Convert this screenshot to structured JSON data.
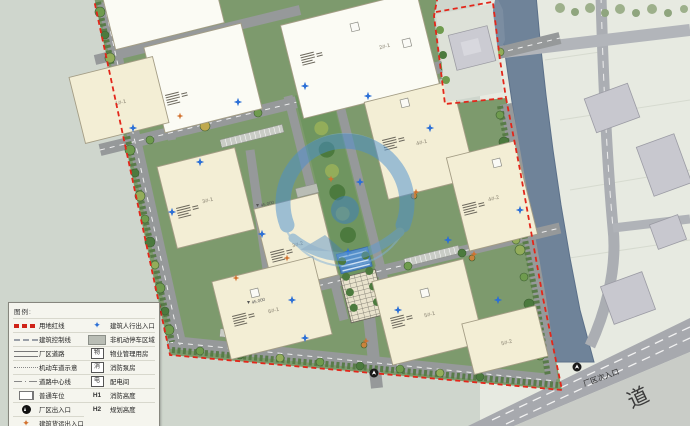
{
  "map": {
    "secondary_entrance_label": "厂区次入口",
    "road_label": "道",
    "elevations": [
      "45.000",
      "45.000"
    ]
  },
  "buildings": [
    {
      "label": "2#-1"
    },
    {
      "label": "1#-1"
    },
    {
      "label": "3#-1"
    },
    {
      "label": "3#-2"
    },
    {
      "label": "6#-1"
    },
    {
      "label": "4#-1"
    },
    {
      "label": "4#-2"
    },
    {
      "label": "5#-1"
    },
    {
      "label": "5#-2"
    }
  ],
  "legend": {
    "title": "图例:",
    "left": [
      {
        "label": "用地红线"
      },
      {
        "label": "建筑控制线"
      },
      {
        "label": "厂区道路"
      },
      {
        "label": "机动车道示意"
      },
      {
        "label": "道路中心线"
      },
      {
        "label": "普通车位"
      },
      {
        "label": "厂区出入口"
      },
      {
        "label": "建筑货运出入口"
      }
    ],
    "right": [
      {
        "icon": "",
        "label": "建筑人行出入口"
      },
      {
        "icon": "",
        "label": "非机动停车区域"
      },
      {
        "icon": "物",
        "label": "物业管理用房"
      },
      {
        "icon": "消",
        "label": "消防泵房"
      },
      {
        "icon": "电",
        "label": "配电间"
      },
      {
        "icon": "H1",
        "label": "消防高度"
      },
      {
        "icon": "H2",
        "label": "规划高度"
      }
    ]
  },
  "colors": {
    "site_redline": "#E3261A",
    "river": "#6F8399",
    "site_green": "#7D9A6D",
    "building_cream": "#F3EED5",
    "building_white": "#FBFBF4",
    "road_gray": "#96999A",
    "watermark_blue": "#4A8FD0",
    "marker_blue": "#2B6FD6",
    "marker_orange": "#D2712E"
  }
}
